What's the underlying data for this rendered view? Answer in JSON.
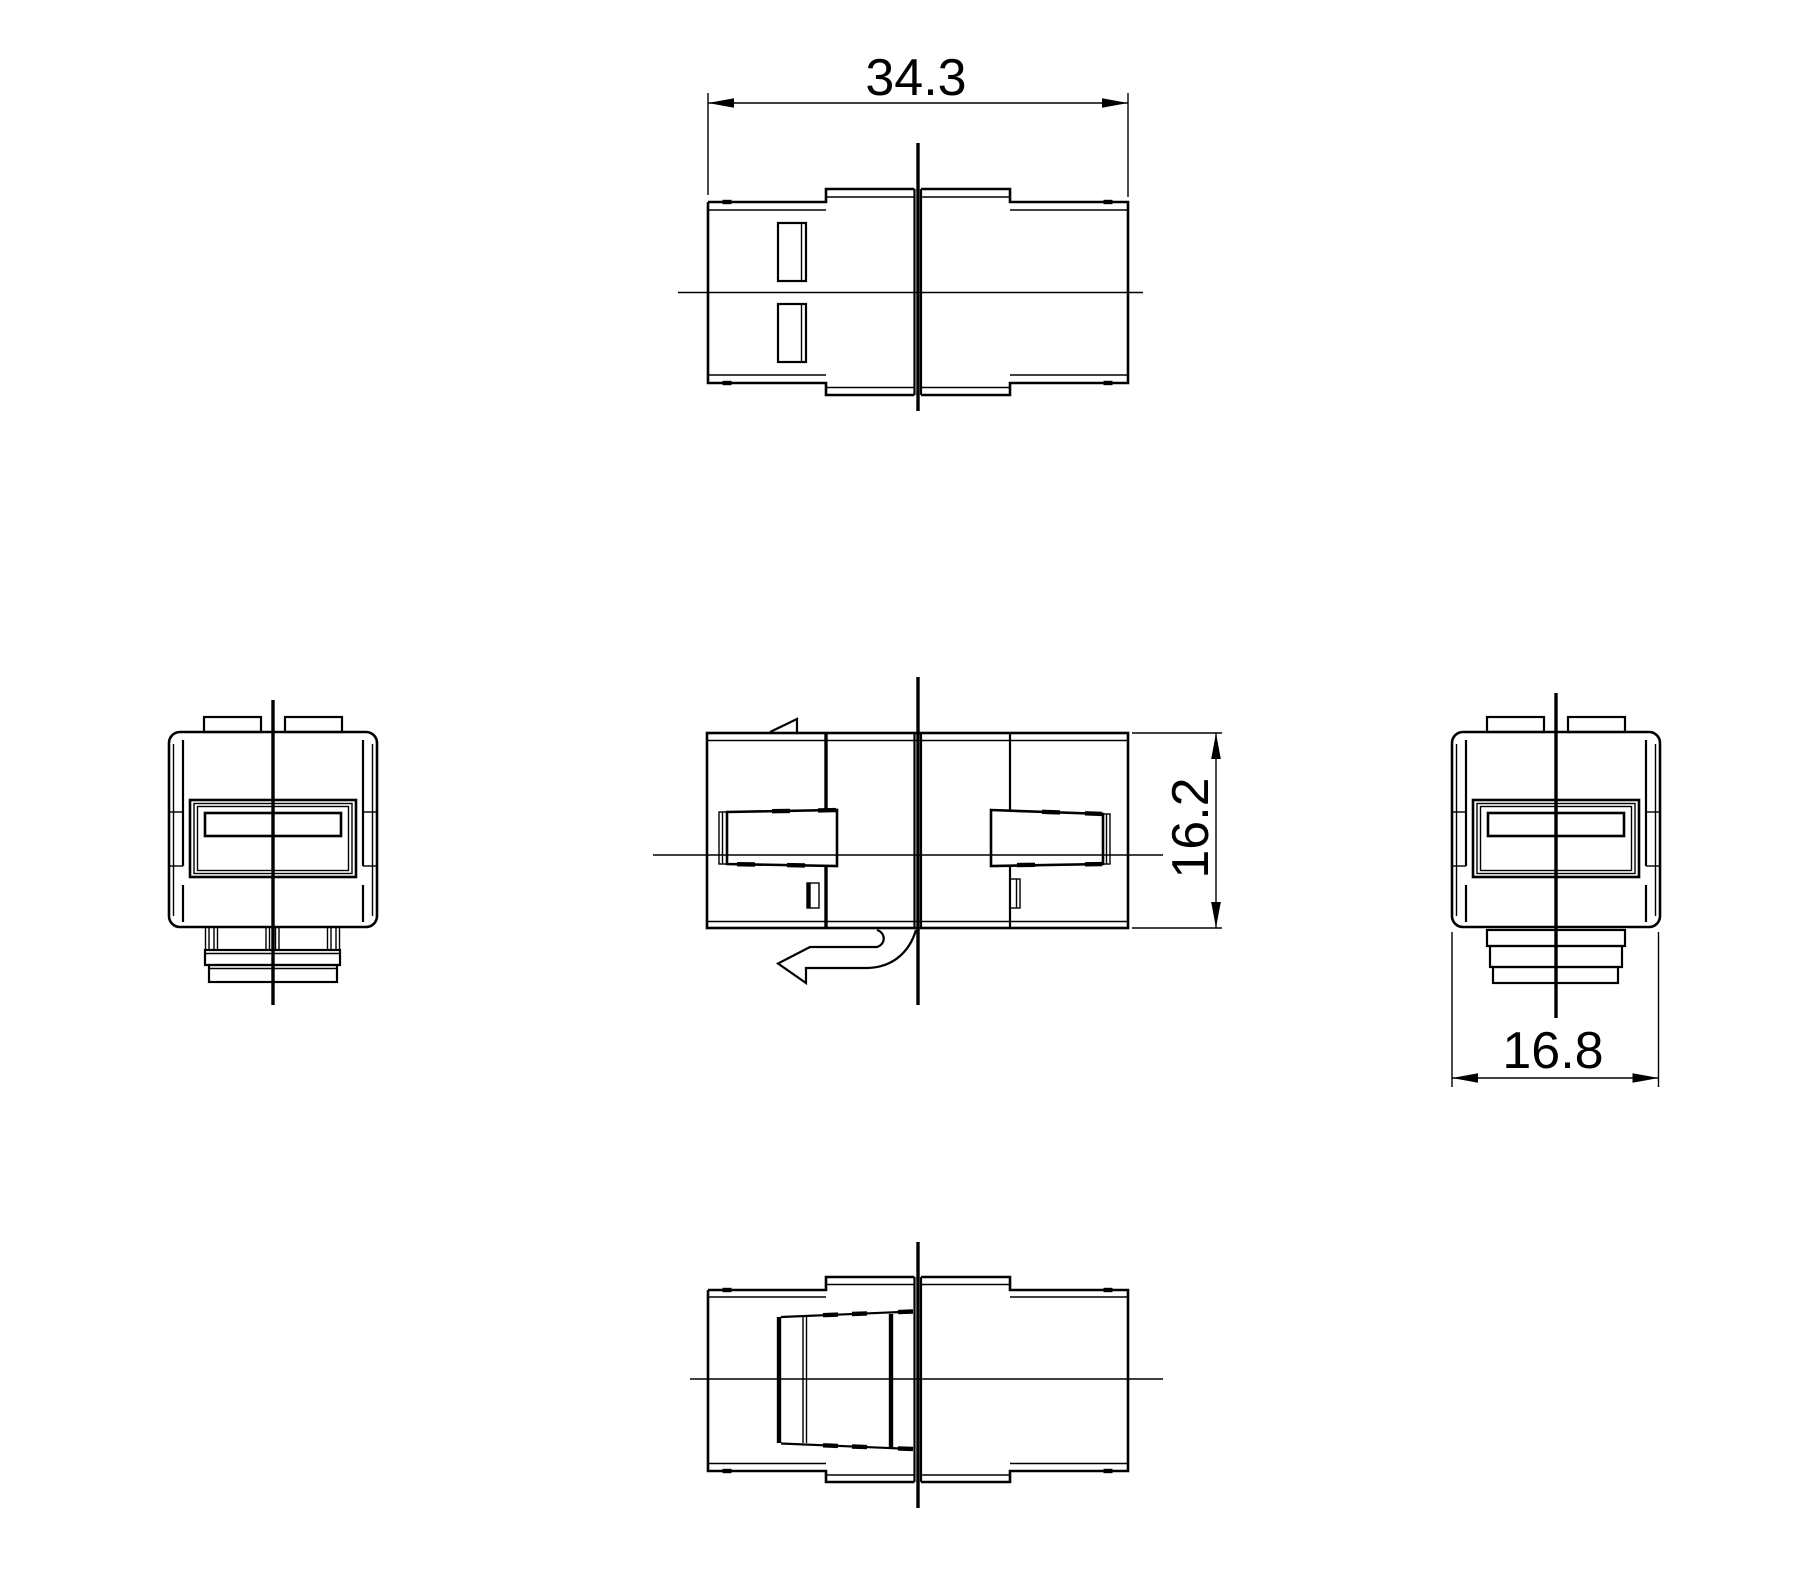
{
  "page": {
    "kind": "orthographic technical drawing",
    "subject": "keystone inline coupler",
    "background_color": "#ffffff",
    "line_color": "#000000"
  },
  "dimensions": {
    "top_width": {
      "value": "34.3",
      "orientation": "horizontal",
      "location": "above top view"
    },
    "body_height": {
      "value": "16.2",
      "orientation": "vertical",
      "location": "right of front view"
    },
    "body_width": {
      "value": "16.8",
      "orientation": "horizontal",
      "location": "below right side view"
    }
  }
}
